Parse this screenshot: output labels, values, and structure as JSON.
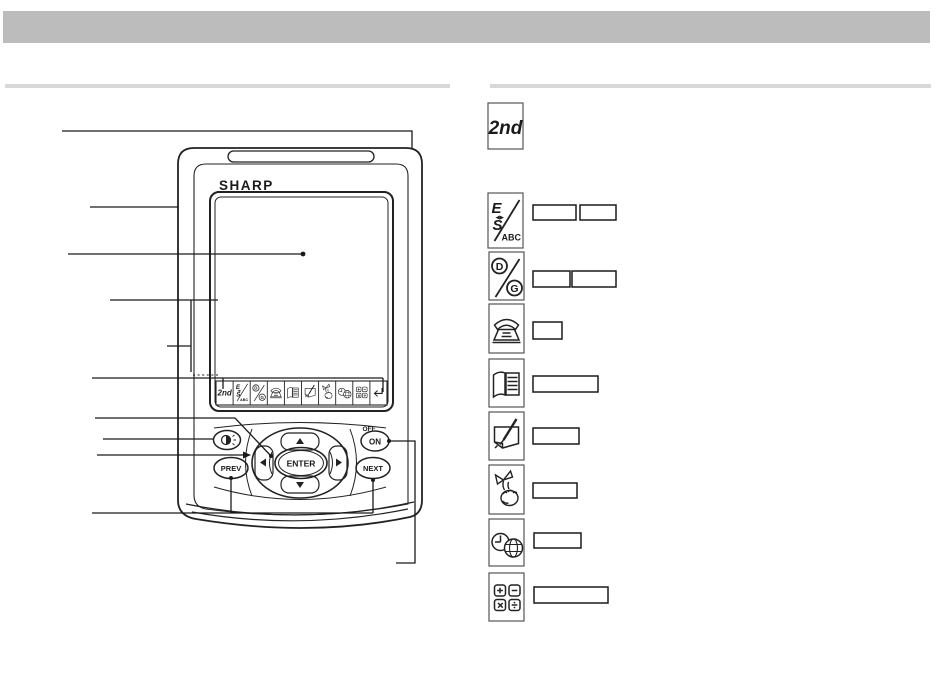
{
  "colors": {
    "header_bar": "#bcbcbc",
    "rule": "#d8d8d8",
    "ink": "#222222"
  },
  "device": {
    "brand": "SHARP",
    "keys": {
      "enter": "ENTER",
      "prev": "PREV",
      "next": "NEXT",
      "on": "ON",
      "off": "OFF"
    }
  },
  "labels": {
    "second": "2nd",
    "e": "E",
    "s": "S",
    "abc": "ABC",
    "d": "D",
    "g": "G",
    "arrows": "◀▶"
  },
  "legend": {
    "rows": [
      {
        "icon": "second-function-key-icon",
        "boxes": 0
      },
      {
        "icon": "language-key-icon",
        "boxes": 2
      },
      {
        "icon": "date-format-key-icon",
        "boxes": 2
      },
      {
        "icon": "phone-mode-icon",
        "boxes": 1
      },
      {
        "icon": "organizer-mode-icon",
        "boxes": 1
      },
      {
        "icon": "memo-mode-icon",
        "boxes": 1
      },
      {
        "icon": "todo-mode-icon",
        "boxes": 1
      },
      {
        "icon": "world-clock-mode-icon",
        "boxes": 1
      },
      {
        "icon": "calculator-mode-icon",
        "boxes": 1
      }
    ]
  }
}
